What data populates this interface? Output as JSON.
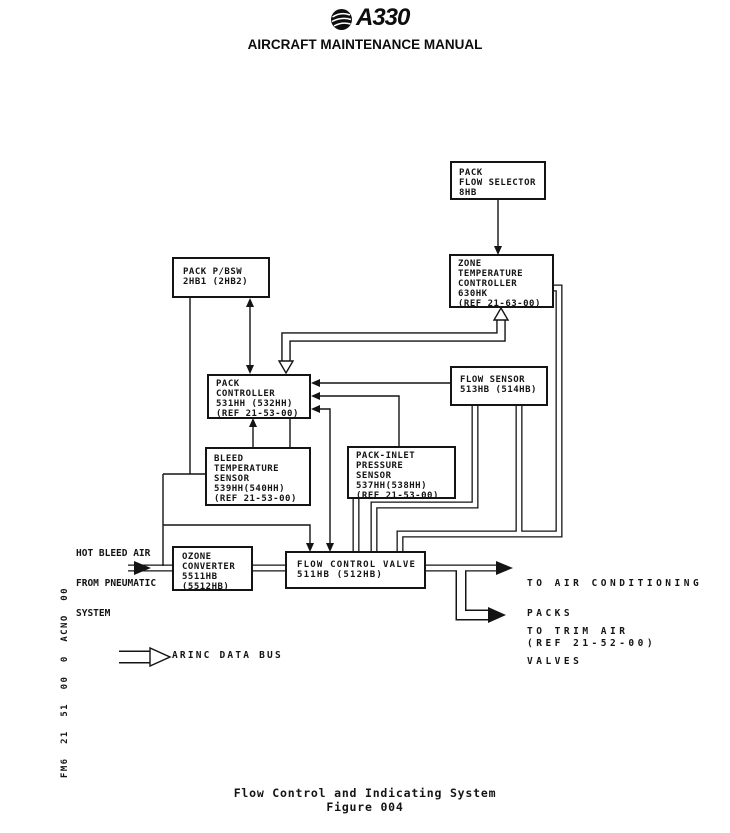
{
  "header": {
    "model": "A330",
    "manual_title": "AIRCRAFT MAINTENANCE MANUAL"
  },
  "ink_color": "#141414",
  "diagram": {
    "boxes": [
      {
        "name": "pack-flow-selector",
        "lines": [
          "PACK",
          "FLOW SELECTOR",
          "8HB"
        ]
      },
      {
        "name": "zone-temperature-controller",
        "lines": [
          "ZONE",
          "TEMPERATURE",
          "CONTROLLER",
          "630HK",
          "(REF 21-63-00)"
        ]
      },
      {
        "name": "pack-pbsw",
        "lines": [
          "PACK P/BSW",
          "2HB1 (2HB2)"
        ]
      },
      {
        "name": "pack-controller",
        "lines": [
          "PACK",
          "CONTROLLER",
          "531HH (532HH)",
          "(REF 21-53-00)"
        ]
      },
      {
        "name": "flow-sensor",
        "lines": [
          "FLOW SENSOR",
          "513HB (514HB)"
        ]
      },
      {
        "name": "bleed-temperature-sensor",
        "lines": [
          "BLEED",
          "TEMPERATURE",
          "SENSOR",
          "539HH(540HH)",
          "(REF 21-53-00)"
        ]
      },
      {
        "name": "pack-inlet-pressure-sensor",
        "lines": [
          "PACK-INLET",
          "PRESSURE",
          "SENSOR",
          "537HH(538HH)",
          "(REF 21-53-00)"
        ]
      },
      {
        "name": "ozone-converter",
        "lines": [
          "OZONE",
          "CONVERTER",
          "5511HB",
          "(5512HB)"
        ]
      },
      {
        "name": "flow-control-valve",
        "lines": [
          "FLOW CONTROL VALVE",
          "511HB (512HB)"
        ]
      }
    ],
    "labels": {
      "hot_bleed": [
        "HOT BLEED AIR",
        "FROM PNEUMATIC",
        "SYSTEM"
      ],
      "to_packs": [
        "TO AIR CONDITIONING",
        "PACKS",
        "(REF 21-52-00)"
      ],
      "to_trim": [
        "TO TRIM AIR",
        "VALVES"
      ],
      "arinc_legend": "ARINC DATA BUS"
    }
  },
  "document_code": "FM6  21  51  00  0  ACNO  00",
  "footer": {
    "caption": "Flow Control and Indicating System",
    "figure": "Figure 004"
  }
}
